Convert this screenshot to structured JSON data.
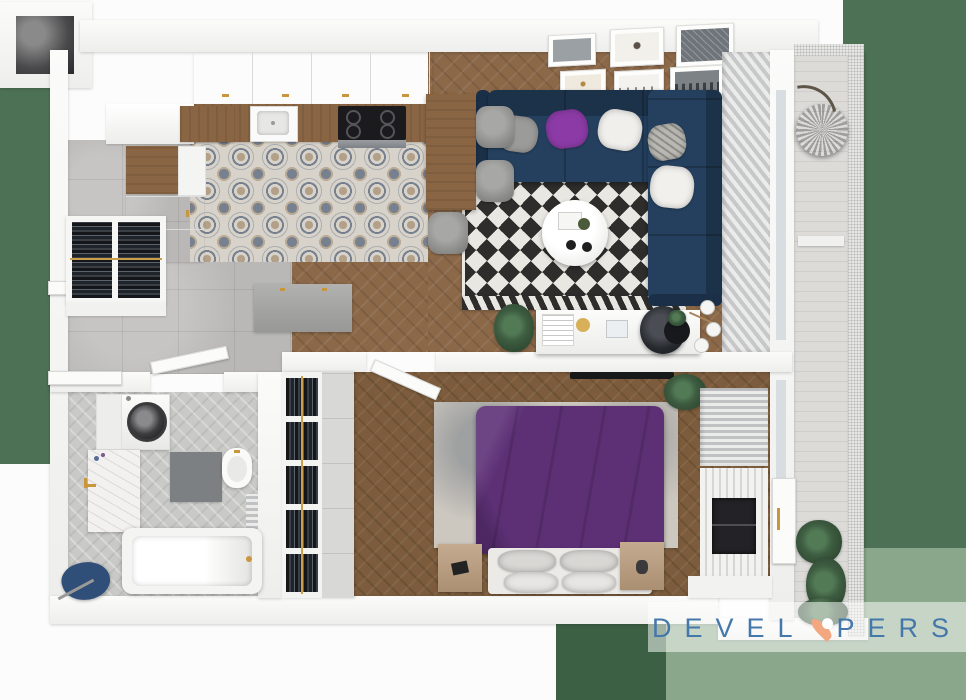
{
  "watermark": {
    "brand": "DEVELOPERS",
    "left": "DEVEL",
    "right": "PERS",
    "pin": "location-pin-icon"
  },
  "palette": {
    "bg": "#fcfcfc",
    "green-dark": "#4d7154",
    "green-deep": "#3c6044",
    "green-sage": "#8aa78b",
    "wood": "#8b6848",
    "wood-dark": "#7c5c3c",
    "wood-cab": "#8a6544",
    "tile-base": "#d8d3ca",
    "tile-ink": "#77808e",
    "tile-tan": "#b2a089",
    "concrete": "#b9b8b6",
    "bath-tile": "#c9c9c7",
    "navy": "#24405e",
    "navy-dark": "#1b3048",
    "purple-pillow": "#8c3ba6",
    "purple-bed": "#5d3076",
    "rug-white": "#e9e7e2",
    "rug-black": "#2e2d2b",
    "bed-rug": "#ccc7bf",
    "gold": "#c9963e",
    "plant": "#3d5c40",
    "plant-dark": "#2c452f",
    "balcony-floor": "#dcdbd8",
    "mesh": "#e6e6e5",
    "logo-blue": "#4478ab",
    "logo-pin": "#f2a780"
  },
  "scene": {
    "view": "top-down 3d apartment floor plan render",
    "rooms": [
      {
        "name": "kitchen",
        "items": [
          "upper-cabinets",
          "wood-countertop",
          "sink",
          "induction-hob",
          "tall-cabinets",
          "patterned-tile-floor"
        ]
      },
      {
        "name": "dining-area",
        "items": [
          "wood-table",
          "gray-chairs"
        ]
      },
      {
        "name": "living-room",
        "items": [
          "navy-corner-sofa",
          "throw-pillows",
          "diamond-rug",
          "round-coffee-table",
          "gallery-wall",
          "desk",
          "desk-chair",
          "floor-lamp"
        ]
      },
      {
        "name": "hallway",
        "items": [
          "wardrobe-hanging-clothes",
          "storage-bench",
          "entry-door"
        ]
      },
      {
        "name": "bathroom",
        "items": [
          "washing-machine",
          "vanity-sink",
          "toilet",
          "bathtub",
          "bath-mat",
          "blue-towel"
        ]
      },
      {
        "name": "bedroom",
        "items": [
          "purple-double-bed",
          "area-rug",
          "nightstands",
          "wardrobe-hanging-clothes",
          "tv",
          "slat-feature-wall",
          "radiator"
        ]
      },
      {
        "name": "balcony",
        "items": [
          "hanging-egg-chair",
          "mesh-railing",
          "plants"
        ]
      }
    ]
  }
}
